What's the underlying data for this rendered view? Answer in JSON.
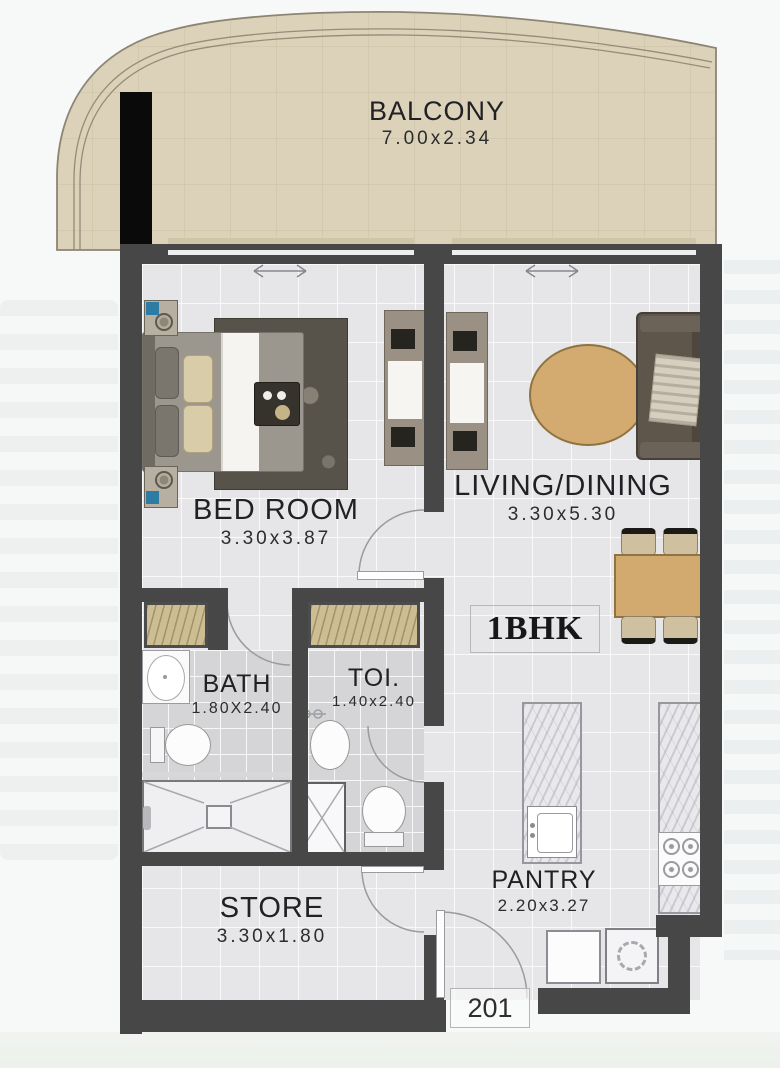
{
  "plan": {
    "unit_type": "1BHK",
    "unit_number": "201",
    "rooms": {
      "balcony": {
        "name": "BALCONY",
        "dimensions": "7.00x2.34"
      },
      "bedroom": {
        "name": "BED ROOM",
        "dimensions": "3.30x3.87"
      },
      "living_dining": {
        "name": "LIVING/DINING",
        "dimensions": "3.30x5.30"
      },
      "bath": {
        "name": "BATH",
        "dimensions": "1.80X2.40"
      },
      "toilet": {
        "name": "TOI.",
        "dimensions": "1.40x2.40"
      },
      "store": {
        "name": "STORE",
        "dimensions": "3.30x1.80"
      },
      "pantry": {
        "name": "PANTRY",
        "dimensions": "2.20x3.27"
      }
    },
    "colors": {
      "wall": "#474747",
      "balcony_floor": "#dbd2b9",
      "interior_floor": "#e6e6e8",
      "wet_room_floor": "#d5d5d8",
      "accent_tan": "#d2a96e",
      "closet_wood": "#cdbd92",
      "sofa_brown": "#5e564b",
      "column_black": "#0a0a0a"
    }
  }
}
